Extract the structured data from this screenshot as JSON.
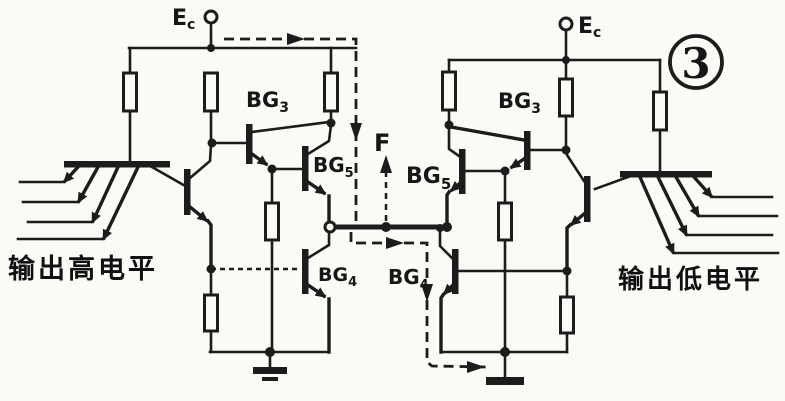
{
  "figure": {
    "badge_number": "3",
    "supply_left": {
      "main": "E",
      "sub": "c"
    },
    "supply_right": {
      "main": "E",
      "sub": "c"
    },
    "transistors": {
      "left_bg3": {
        "main": "BG",
        "sub": "3"
      },
      "left_bg5": {
        "main": "BG",
        "sub": "5"
      },
      "left_bg4": {
        "main": "BG",
        "sub": "4"
      },
      "right_bg3": {
        "main": "BG",
        "sub": "3"
      },
      "right_bg5": {
        "main": "BG",
        "sub": "5"
      },
      "right_bg4": {
        "main": "BG",
        "sub": "4"
      }
    },
    "net_label": "F",
    "caption_left": "输出高电平",
    "caption_right": "输出低电平",
    "colors": {
      "ink": "#1c1c1c",
      "paper": "#fbfaf6"
    }
  }
}
